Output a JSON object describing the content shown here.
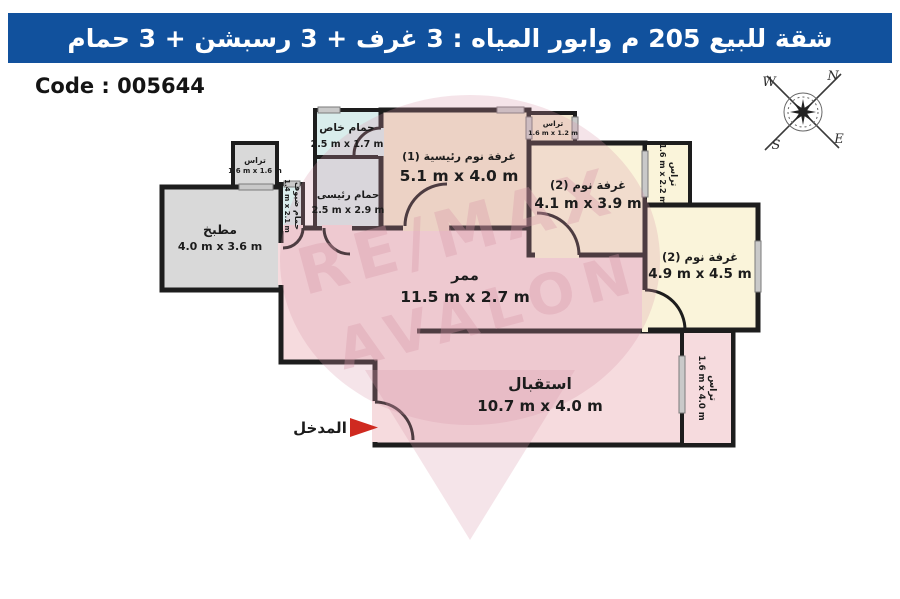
{
  "header": {
    "title": "شقة للبيع 205 م وابور المياه  :  3 غرف + 3 رسبشن + 3 حمام"
  },
  "code_label": "Code : 005644",
  "compass": {
    "north": "N",
    "east": "E",
    "south": "S",
    "west": "W"
  },
  "watermark": {
    "line1": "RE/MAX",
    "line2": "AVALON"
  },
  "entrance": {
    "label": "المدخل"
  },
  "rooms": {
    "kitchen_terrace": {
      "name": "تراس",
      "dims": "1.6 m x 1.6 m"
    },
    "kitchen": {
      "name": "مطبخ",
      "dims": "4.0 m x 3.6 m"
    },
    "guest_bath": {
      "name": "حمام ضيوف",
      "dims": "1.4 m x 2.1 m"
    },
    "private_bath": {
      "name": "حمام خاص",
      "dims": "2.5 m x 1.7 m"
    },
    "master_bath": {
      "name": "حمام رئيسى",
      "dims": "2.5 m x 2.9 m"
    },
    "master_bedroom": {
      "name": "غرفة نوم رئيسية (1)",
      "dims": "5.1 m x 4.0 m"
    },
    "terrace_1": {
      "name": "تراس",
      "dims": "1.6 m x 1.2 m"
    },
    "bedroom_2": {
      "name": "غرفة نوم (2)",
      "dims": "4.1 m x 3.9 m"
    },
    "terrace_2": {
      "name": "تراس",
      "dims": "1.6 m x 2.2 m"
    },
    "bedroom_3": {
      "name": "غرفة نوم (2)",
      "dims": "4.9 m x 4.5 m"
    },
    "corridor": {
      "name": "ممر",
      "dims": "11.5 m x 2.7 m"
    },
    "reception": {
      "name": "استقبال",
      "dims": "10.7 m x 4.0 m"
    },
    "terrace_3": {
      "name": "تراس",
      "dims": "1.6 m x 4.0 m"
    }
  },
  "colors": {
    "header_bg": "#11519d",
    "header_text": "#ffffff",
    "wall": "#1d1d1d",
    "pink": "#f6dbde",
    "cyan": "#d9edec",
    "beige": "#f3e7cf",
    "cream": "#faf4da",
    "gray": "#d9d9d9",
    "window": "#c9c9c9",
    "arrow_red": "#cf2a20",
    "watermark_pink": "#d898a9"
  }
}
